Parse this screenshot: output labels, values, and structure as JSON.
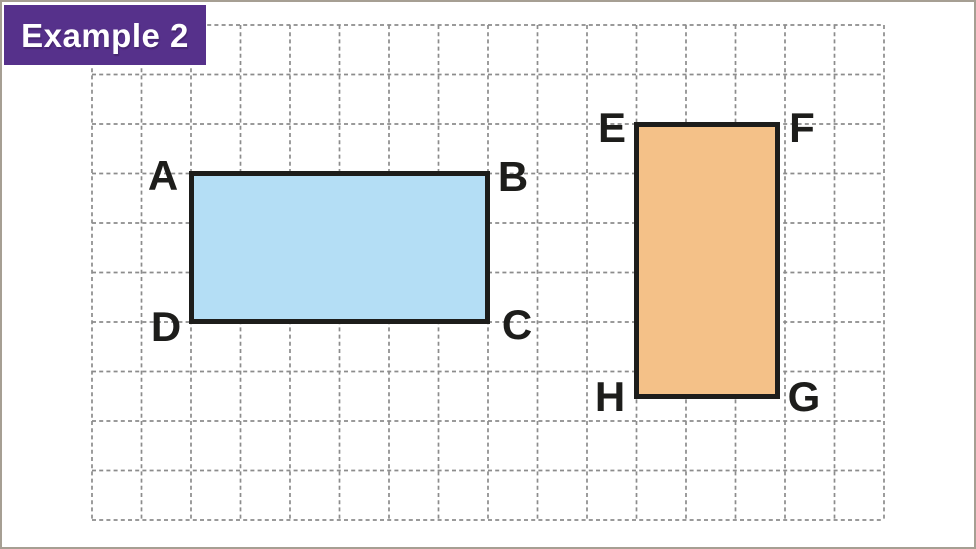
{
  "badge": {
    "label": "Example 2"
  },
  "colors": {
    "page_bg": "#ffffff",
    "page_border": "#a69f93",
    "grid_line": "#8c8c8c",
    "badge_bg": "#56318b",
    "badge_text": "#ffffff",
    "shape_stroke": "#1d1d1b",
    "label_color": "#1d1d1b",
    "rect_abcd_fill": "#b4def5",
    "rect_efgh_fill": "#f4c188"
  },
  "shapes": {
    "rect_abcd": {
      "labels": {
        "top_left": "A",
        "top_right": "B",
        "bottom_right": "C",
        "bottom_left": "D"
      }
    },
    "rect_efgh": {
      "labels": {
        "top_left": "E",
        "top_right": "F",
        "bottom_right": "G",
        "bottom_left": "H"
      }
    }
  }
}
